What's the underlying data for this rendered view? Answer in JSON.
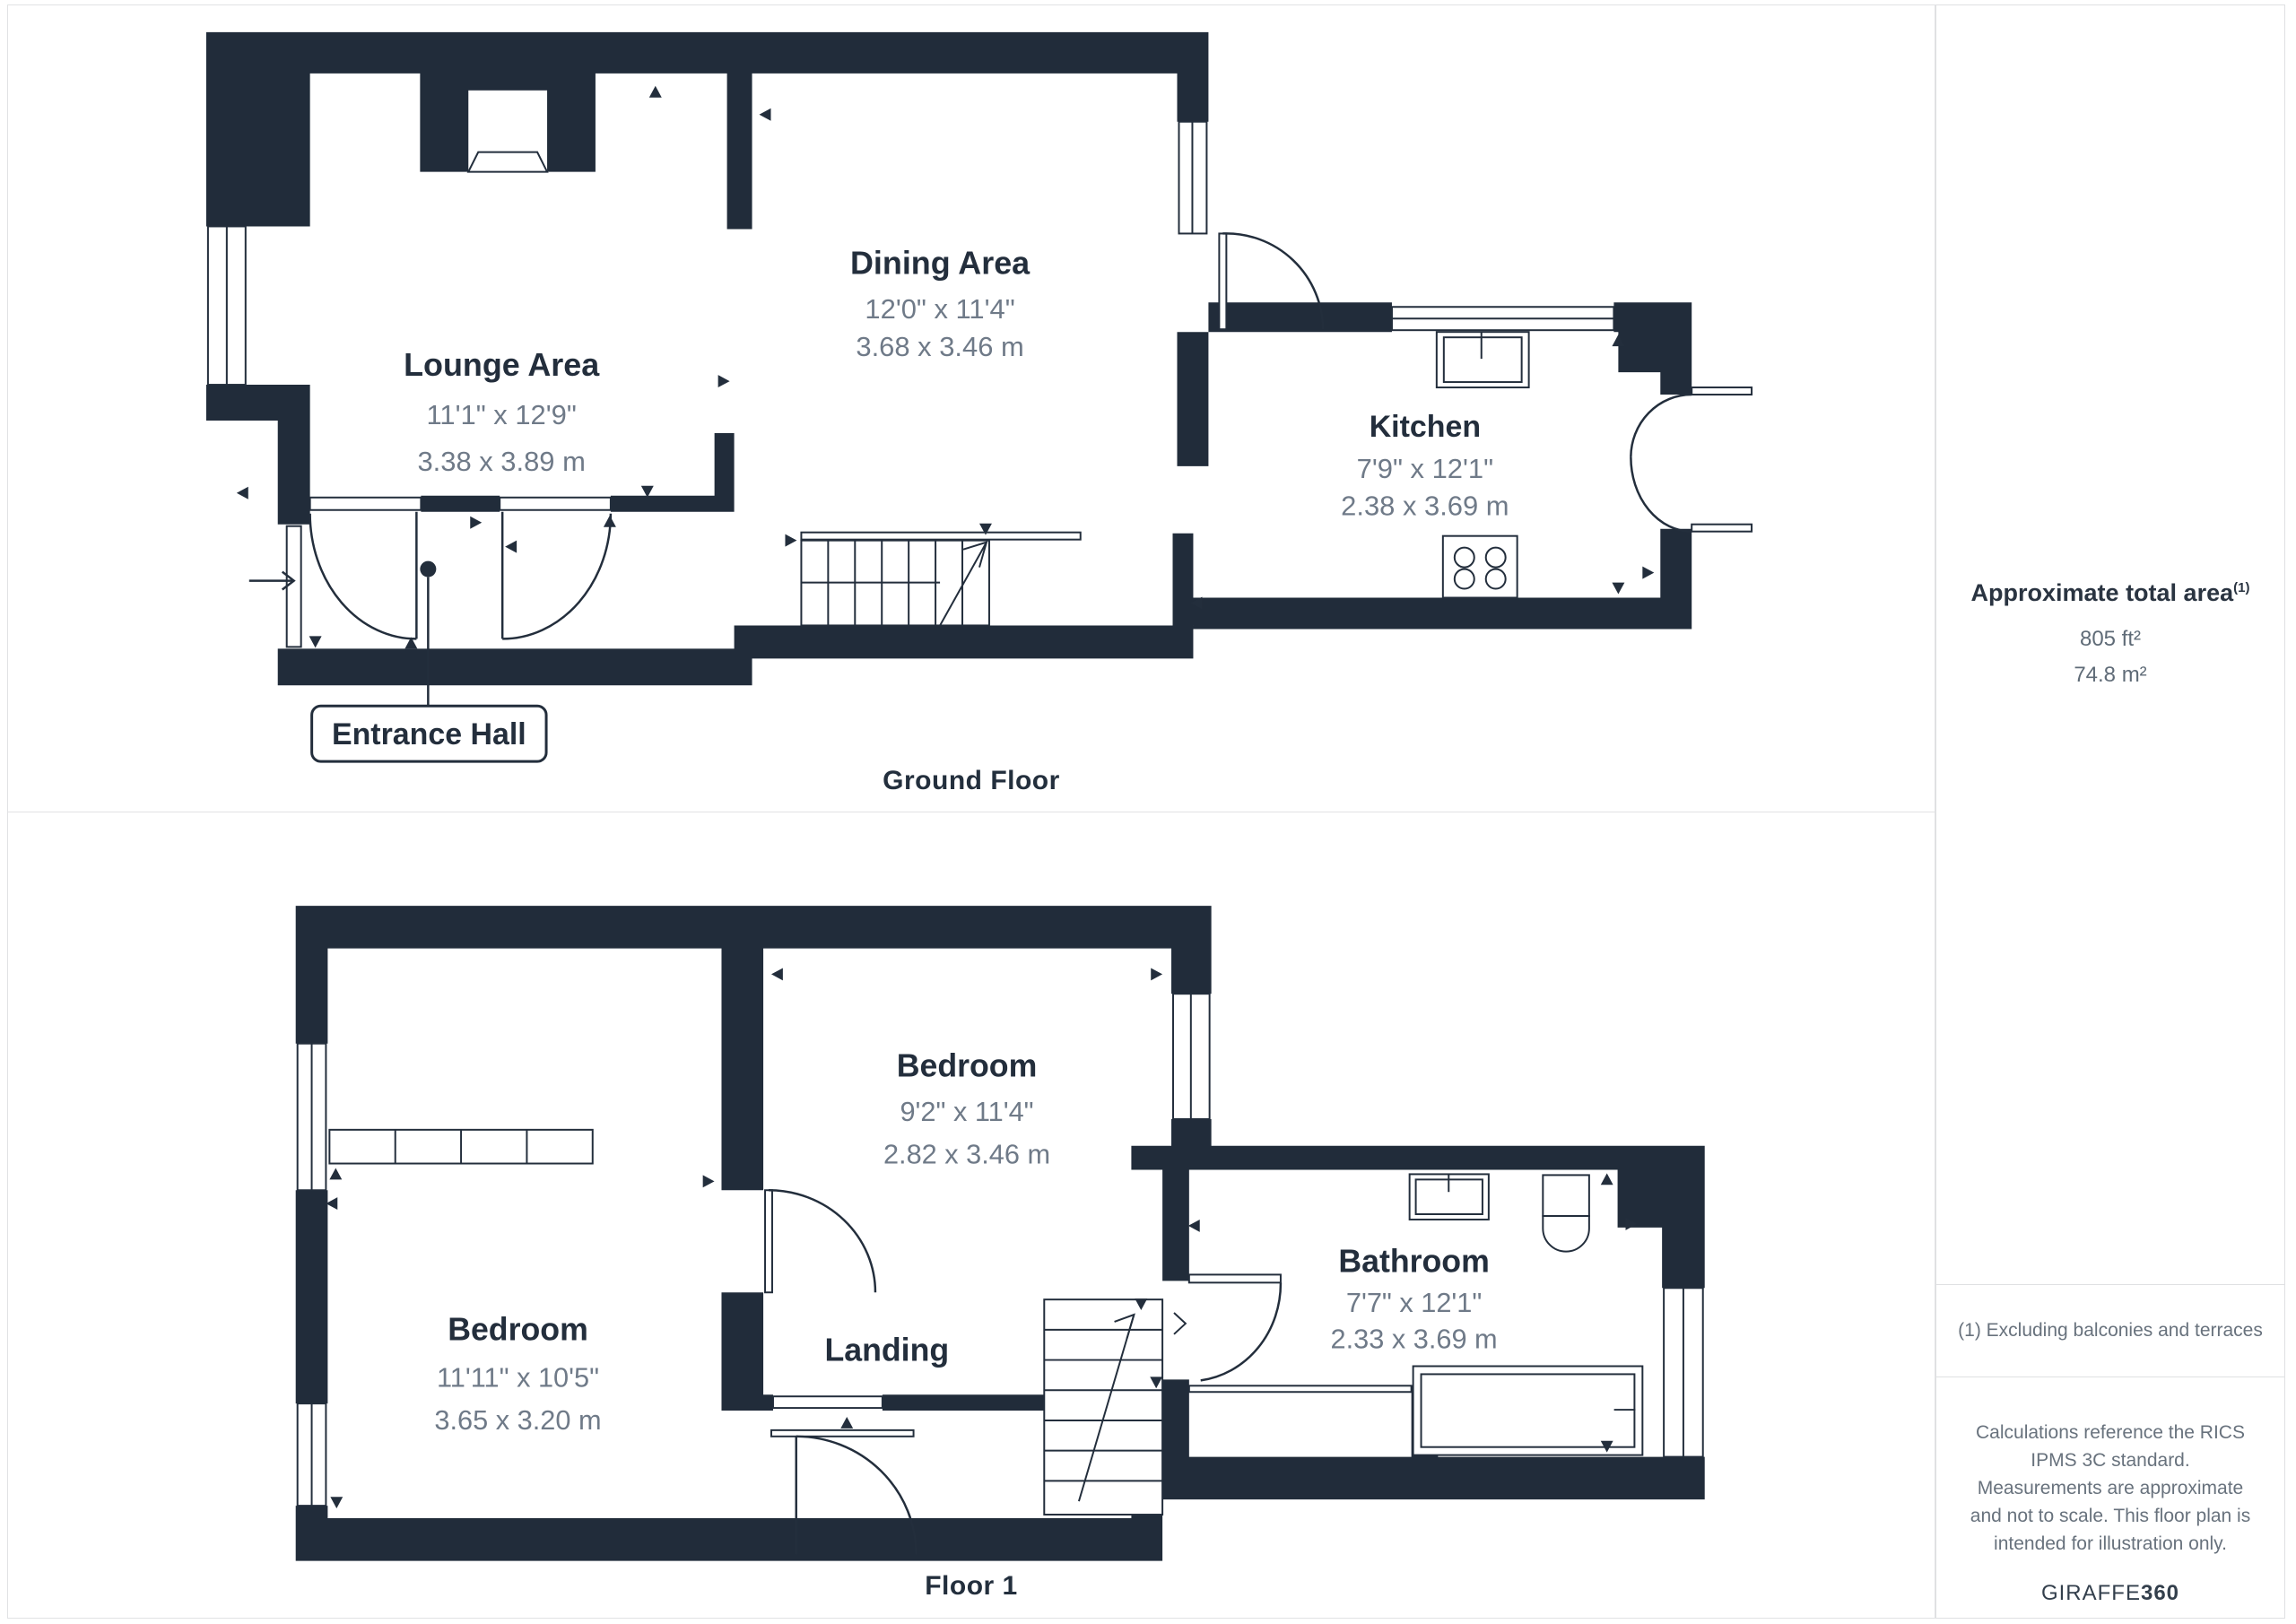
{
  "colors": {
    "wall": "#212c3a",
    "title_text": "#232e3c",
    "dim_text": "#6f7a88",
    "panel_border": "#e1e2e4"
  },
  "ground_floor": {
    "floor_label": "Ground Floor",
    "hall_label": "Entrance Hall",
    "rooms": [
      {
        "name": "Lounge Area",
        "imperial": "11'1\" x 12'9\"",
        "metric": "3.38 x 3.89 m"
      },
      {
        "name": "Dining Area",
        "imperial": "12'0\" x 11'4\"",
        "metric": "3.68 x 3.46 m"
      },
      {
        "name": "Kitchen",
        "imperial": "7'9\" x 12'1\"",
        "metric": "2.38 x 3.69 m"
      }
    ]
  },
  "floor_one": {
    "floor_label": "Floor 1",
    "landing_label": "Landing",
    "rooms": [
      {
        "name": "Bedroom",
        "imperial": "11'11\" x 10'5\"",
        "metric": "3.65 x 3.20 m"
      },
      {
        "name": "Bedroom",
        "imperial": "9'2\" x 11'4\"",
        "metric": "2.82 x 3.46 m"
      },
      {
        "name": "Bathroom",
        "imperial": "7'7\" x 12'1\"",
        "metric": "2.33 x 3.69 m"
      }
    ]
  },
  "sidebar": {
    "area_title": "Approximate total area",
    "area_superscript": "(1)",
    "area_sqft": "805 ft²",
    "area_sqm": "74.8 m²",
    "footnote": "(1) Excluding balconies and terraces",
    "disclaimer": "Calculations reference the RICS IPMS 3C standard. Measurements are approximate and not to scale. This floor plan is intended for illustration only.",
    "brand": {
      "name": "GIRAFFE",
      "suffix": "360"
    }
  }
}
